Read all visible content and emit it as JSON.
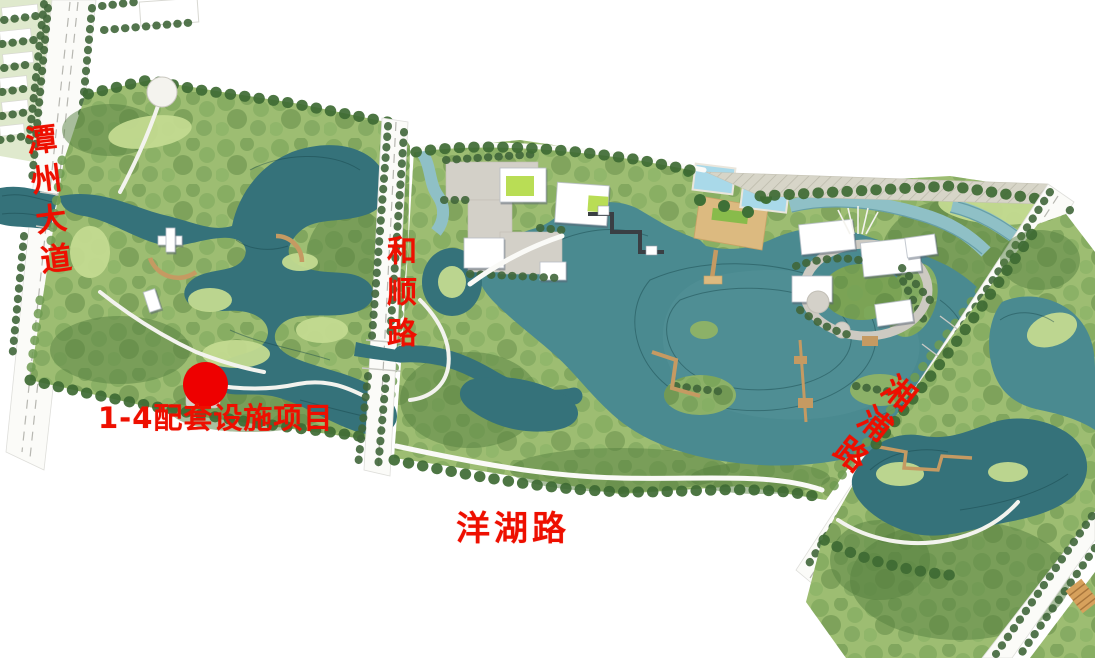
{
  "map": {
    "type": "landscape-masterplan",
    "background_color": "#ffffff",
    "annotation_color": "#ee0f00",
    "roads": {
      "tanzhou": {
        "label": "潭州大道",
        "orientation": "vertical-left"
      },
      "heshun": {
        "label": "和顺路",
        "orientation": "vertical-middle"
      },
      "yanghu": {
        "label": "洋湖路",
        "orientation": "horizontal-bottom"
      },
      "xiangpu": {
        "label": "湘浦路",
        "orientation": "diagonal-right"
      }
    },
    "marker": {
      "label": "1-4配套设施项目",
      "dot_color": "#ee0000"
    },
    "palette": {
      "water_dark": "#35727a",
      "water_lake": "#4a8a90",
      "water_light": "#8fc0c6",
      "tree_dark": "#3e6a33",
      "tree_mid": "#6f9a50",
      "grass_base": "#9dbd72",
      "grass_light": "#c3da90",
      "road_white": "#fbfbf8",
      "plaza_gray": "#d3d0c8",
      "boardwalk_tan": "#c59a62",
      "pool_blue": "#a9d9e9",
      "deck_tan": "#dcba80"
    }
  }
}
